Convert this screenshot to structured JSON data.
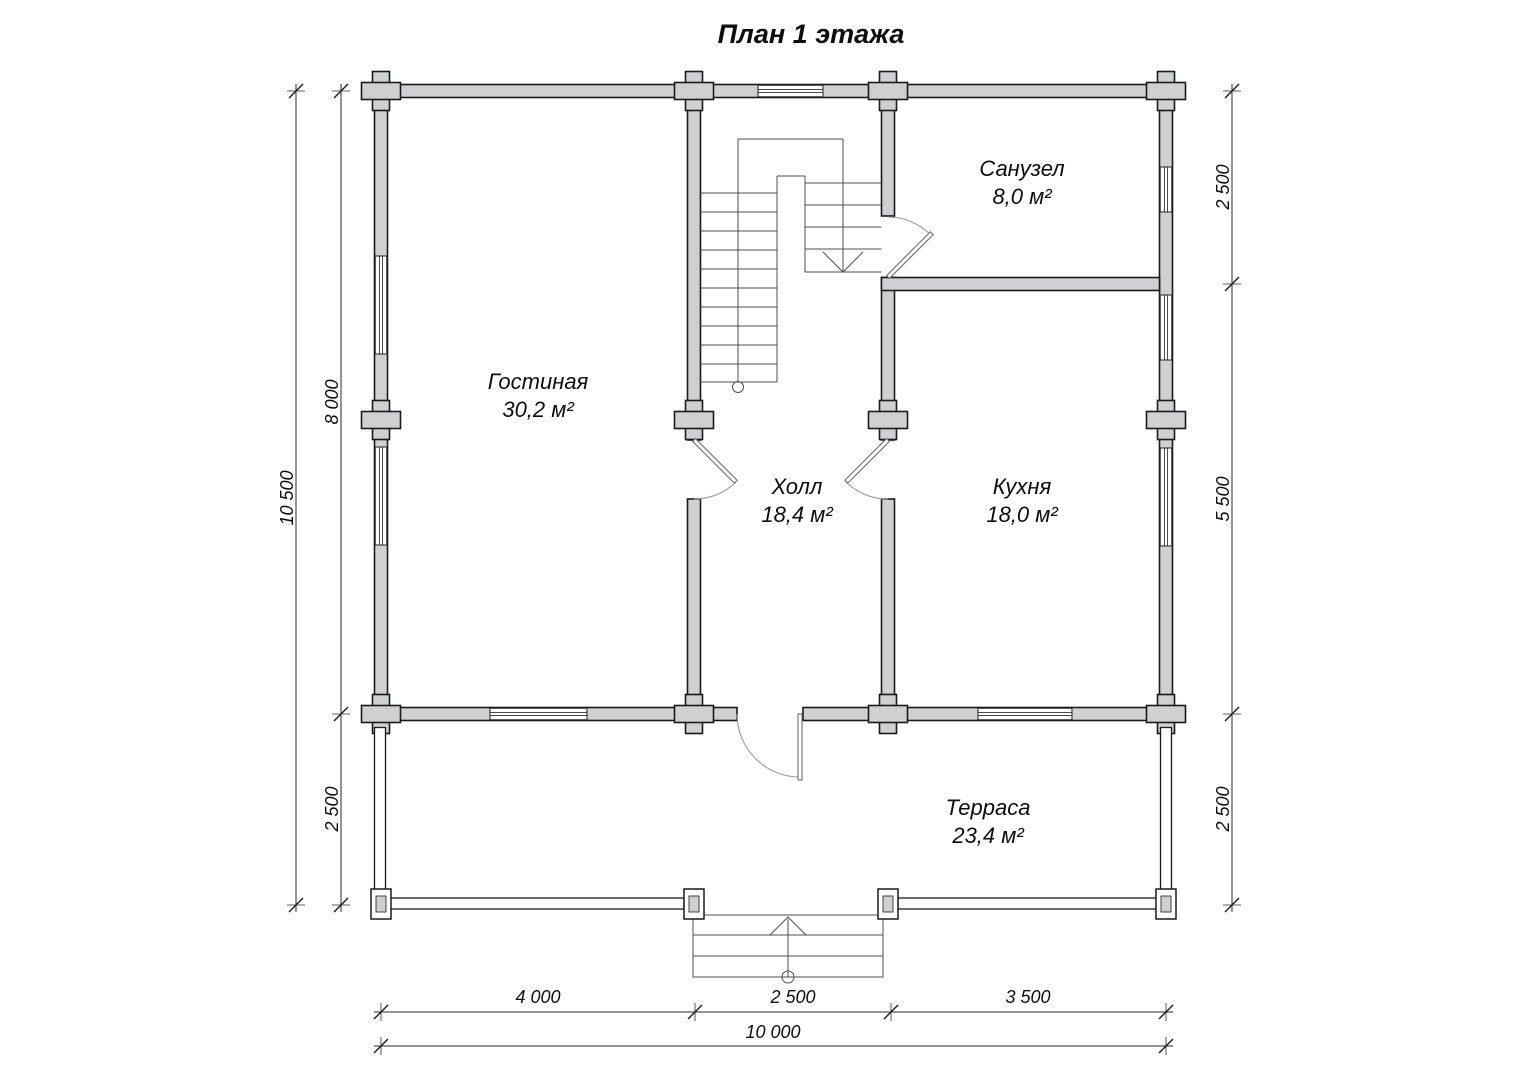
{
  "title": "План 1 этажа",
  "rooms": {
    "living": {
      "name": "Гостиная",
      "area": "30,2 м²"
    },
    "bathroom": {
      "name": "Санузел",
      "area": "8,0 м²"
    },
    "hall": {
      "name": "Холл",
      "area": "18,4 м²"
    },
    "kitchen": {
      "name": "Кухня",
      "area": "18,0 м²"
    },
    "terrace": {
      "name": "Терраса",
      "area": "23,4 м²"
    }
  },
  "dimensions": {
    "left_total": "10 500",
    "left_upper": "8 000",
    "left_lower": "2 500",
    "right_top": "2 500",
    "right_middle": "5 500",
    "right_bottom": "2 500",
    "bottom_left": "4 000",
    "bottom_center": "2 500",
    "bottom_right": "3 500",
    "bottom_total": "10 000"
  },
  "colors": {
    "wall_fill": "#cfd0d1",
    "outline": "#1a1a1a",
    "thin_line": "#555555",
    "background": "#ffffff"
  }
}
